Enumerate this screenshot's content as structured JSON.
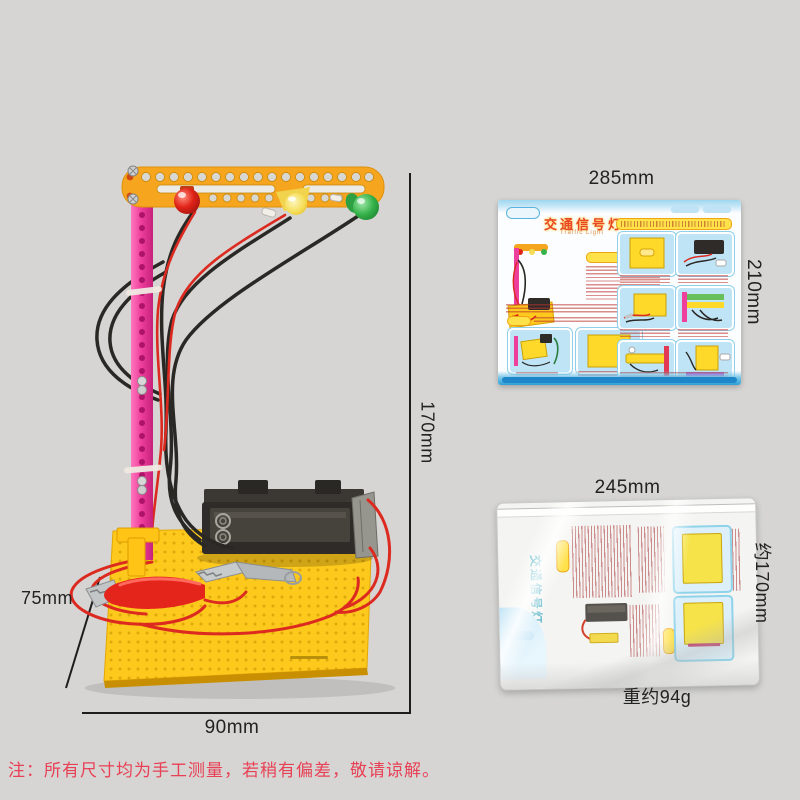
{
  "page": {
    "background_color": "#d6d5d3",
    "disclaimer_note": "注：所有尺寸均为手工测量，若稍有偏差，敬请谅解。"
  },
  "model": {
    "description": "DIY traffic light science kit on perforated base",
    "height_label": "170mm",
    "base_width_label": "90mm",
    "base_depth_label": "75mm",
    "colors": {
      "arm": "#f5a51e",
      "pole": "#ee3f9c",
      "base_plate": "#fdc91d",
      "led_red": "#e02318",
      "led_yellow": "#f5dd55",
      "led_green": "#36b24a",
      "battery_holder": "#2e2b28",
      "wire_red": "#dc2a20",
      "wire_black": "#2a2825"
    }
  },
  "manual": {
    "title": "交通信号灯",
    "subtitle": "Traffic Light",
    "width_label": "285mm",
    "height_label": "210mm"
  },
  "package": {
    "title": "交通信号灯",
    "width_label": "245mm",
    "height_label": "约170mm",
    "weight_label": "重约94g"
  }
}
